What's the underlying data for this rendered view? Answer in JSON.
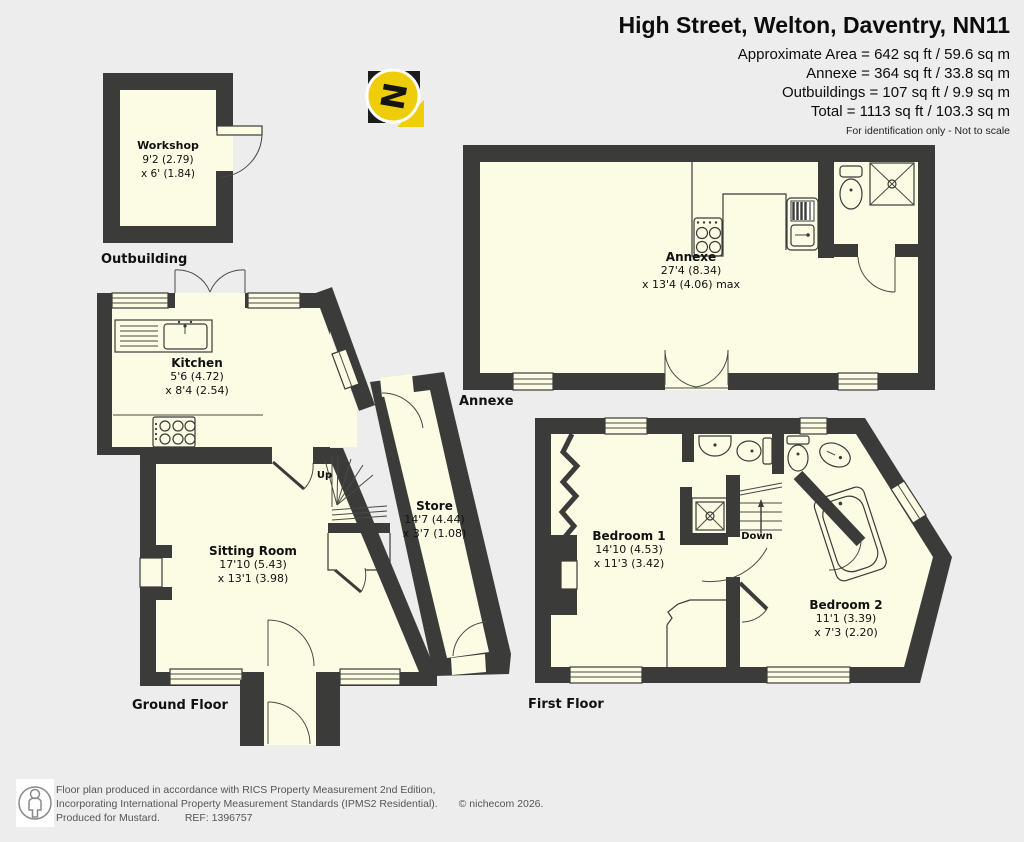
{
  "header": {
    "title": "High Street, Welton, Daventry, NN11",
    "area_lines": [
      "Approximate Area = 642 sq ft / 59.6 sq m",
      "Annexe = 364 sq ft / 33.8 sq m",
      "Outbuildings = 107 sq ft / 9.9 sq m",
      "Total = 1113 sq ft / 103.3 sq m"
    ],
    "disclaimer": "For identification only - Not to scale"
  },
  "compass": {
    "label": "N"
  },
  "floors": {
    "outbuilding": {
      "section_label": "Outbuilding",
      "rooms": [
        {
          "name": "Workshop",
          "dim1": "9'2 (2.79)",
          "dim2": "x 6' (1.84)"
        }
      ]
    },
    "annexe": {
      "section_label": "Annexe",
      "rooms": [
        {
          "name": "Annexe",
          "dim1": "27'4 (8.34)",
          "dim2": "x 13'4 (4.06) max"
        }
      ]
    },
    "ground": {
      "section_label": "Ground Floor",
      "stairs_label": "Up",
      "rooms": [
        {
          "name": "Kitchen",
          "dim1": "5'6 (4.72)",
          "dim2": "x 8'4 (2.54)"
        },
        {
          "name": "Sitting Room",
          "dim1": "17'10 (5.43)",
          "dim2": "x 13'1 (3.98)"
        },
        {
          "name": "Store",
          "dim1": "14'7 (4.44)",
          "dim2": "x 3'7 (1.08)"
        }
      ]
    },
    "first": {
      "section_label": "First Floor",
      "stairs_label": "Down",
      "rooms": [
        {
          "name": "Bedroom 1",
          "dim1": "14'10 (4.53)",
          "dim2": "x 11'3 (3.42)"
        },
        {
          "name": "Bedroom 2",
          "dim1": "11'1 (3.39)",
          "dim2": "x 7'3 (2.20)"
        }
      ]
    }
  },
  "footer": {
    "line1": "Floor plan produced in accordance with RICS Property Measurement 2nd Edition,",
    "line2": "Incorporating International Property Measurement Standards (IPMS2 Residential).",
    "copyright": "© nichecom 2026.",
    "produced_for": "Produced for Mustard.",
    "ref": "REF: 1396757"
  },
  "colors": {
    "wall": "#3b3b39",
    "room_fill": "#fcfbe4",
    "background": "#ededed",
    "compass_yellow": "#efcd0a"
  }
}
